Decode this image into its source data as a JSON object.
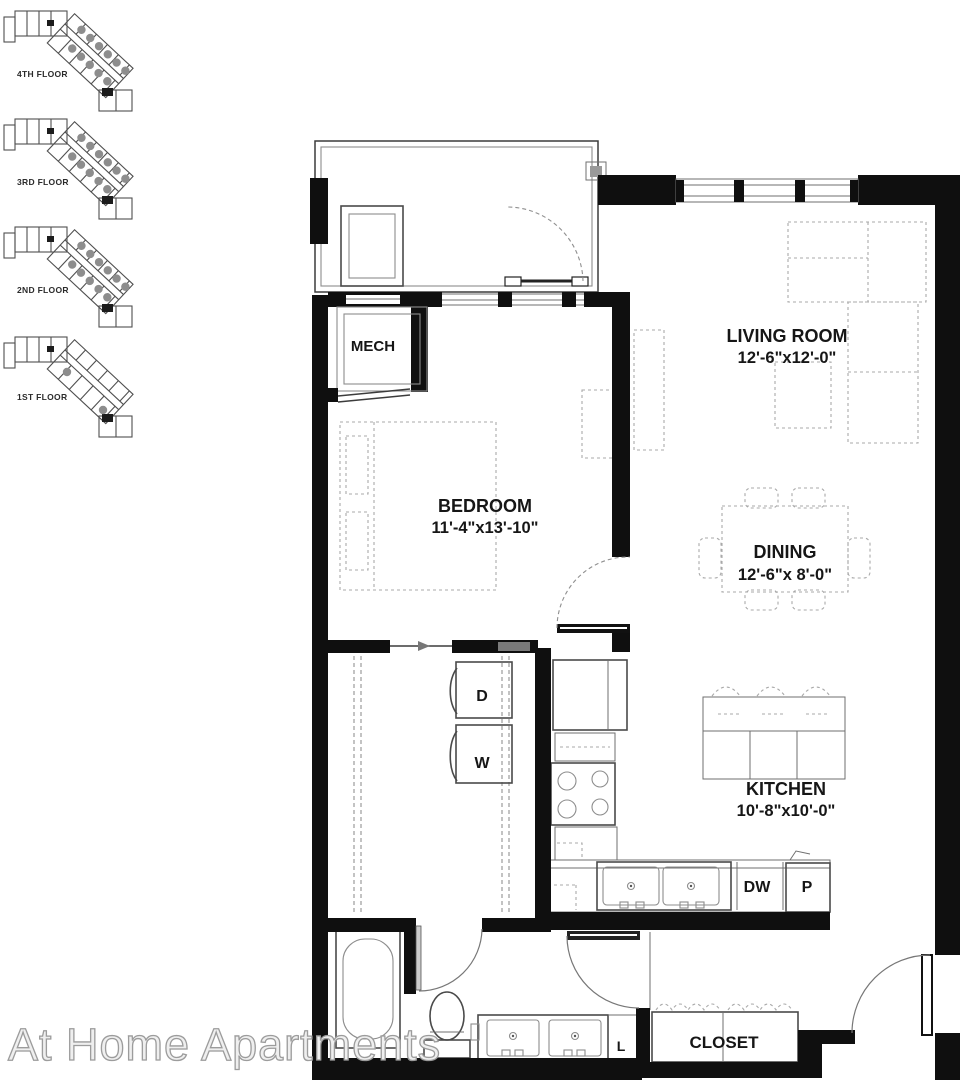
{
  "floor_key": {
    "floors": [
      {
        "label": "4TH FLOOR"
      },
      {
        "label": "3RD FLOOR"
      },
      {
        "label": "2ND FLOOR"
      },
      {
        "label": "1ST FLOOR"
      }
    ]
  },
  "plan": {
    "rooms": {
      "living": {
        "name": "LIVING ROOM",
        "dims": "12'-6\"x12'-0\""
      },
      "bedroom": {
        "name": "BEDROOM",
        "dims": "11'-4\"x13'-10\""
      },
      "dining": {
        "name": "DINING",
        "dims": "12'-6\"x 8'-0\""
      },
      "kitchen": {
        "name": "KITCHEN",
        "dims": "10'-8\"x10'-0\""
      },
      "mech": {
        "name": "MECH"
      },
      "closet": {
        "name": "CLOSET"
      }
    },
    "labels": {
      "dryer": "D",
      "washer": "W",
      "dishwasher": "DW",
      "pantry": "P",
      "linen": "L"
    }
  },
  "watermark": {
    "text": "At Home Apartments"
  },
  "colors": {
    "wall": "#0f0f0f",
    "drawing_line": "#4a4a4a",
    "dashed_furniture": "#9b9b9b",
    "unit_dot": "#8d8d8d",
    "watermark": "#c8c8c8"
  }
}
